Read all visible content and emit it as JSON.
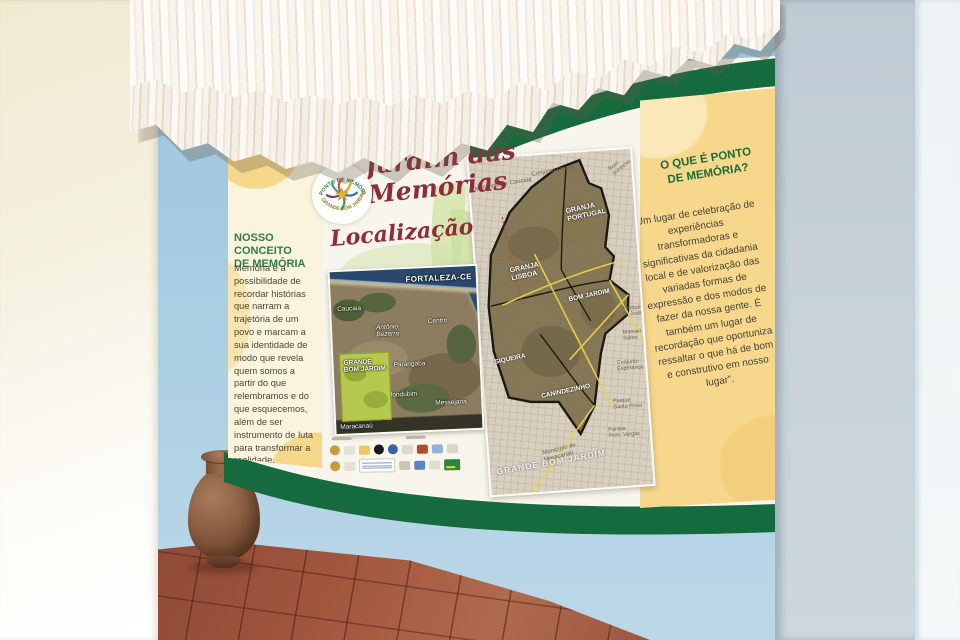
{
  "banner": {
    "title": "Jardim das Memórias",
    "subtitle": "Localização",
    "logo": {
      "top_arc": "PONTO DE MEMÓRIA",
      "bottom_arc": "GRANDE BOM JARDIM"
    },
    "left_panel": {
      "heading": "NOSSO CONCEITO\nDE MEMÓRIA",
      "body": "Memória é a possibilidade de recordar histórias que narram a trajetória de um povo e marcam a sua identidade de modo que revela quem somos a partir do que relembramos e do que esquecemos, além de ser instrumento de luta para transformar a realidade."
    },
    "right_panel": {
      "heading": "O QUE É PONTO\nDE MEMÓRIA?",
      "body": "“Um lugar de celebração de experiências transformadoras e significativas da cidadania local e de valorização das variadas formas de expressão e dos modos de fazer da nossa gente. É também um lugar de recordação que oportuniza ressaltar o que há de bom e construtivo em nosso lugar”."
    },
    "maps": {
      "left": {
        "region_label": "FORTALEZA-CE",
        "highlight": "GRANDE\nBOM JARDIM",
        "labels": {
          "caucaia": "Caucaia",
          "antonio_bezerra": "Antônio\nBezerra",
          "centro": "Centro",
          "parangaba": "Parangaba",
          "mondubim": "Mondubim",
          "messejana": "Messejana",
          "maracanau": "Maracanaú"
        }
      },
      "right": {
        "labels": {
          "municipio_caucaia": "Município de Caucaia",
          "conjunto_ceara": "Conjunto Ceará",
          "bom_sucesso": "Bom\nSucesso",
          "granja_portugal": "GRANJA\nPORTUGAL",
          "granja_lisboa": "GRANJA\nLISBOA",
          "bom_jardim": "BOM JARDIM",
          "parque_s_jose": "Parque\nS. José",
          "siqueira": "SIQUEIRA",
          "canindezinho": "CANINDEZINHO",
          "manoel_satiro": "Manoel\nSátiro",
          "conjunto_esperanca": "Conjunto\nEsperança",
          "parque_santa_rosa": "Parque\nSanta Rosa",
          "parque_pres_vargas": "Parque\nPres. Vargas",
          "municipio_maracanau": "Município de\nMaracanaú",
          "watermark": "GRANDE BOM JARDIM"
        }
      }
    },
    "colors": {
      "stripe_green": "#156a3e",
      "title_red": "#8d2d3a",
      "heading_green": "#1d6b3a",
      "panel_yellow": "#f6d78c"
    }
  }
}
